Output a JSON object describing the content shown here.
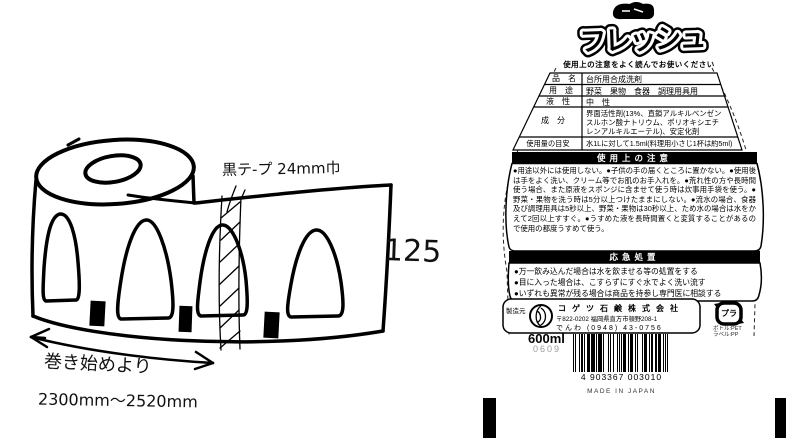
{
  "sketch": {
    "tape_note": "黒テ-プ 24mm巾",
    "count_label": "125",
    "wind_note_line1": "巻き始めより",
    "wind_note_line2": "2300mm〜2520mm"
  },
  "label": {
    "brand": "フレッシュ",
    "caution_header": "使用上の注意をよく読んでお使いください",
    "spec_table": {
      "rows": [
        {
          "label": "品　名",
          "value": "台所用合成洗剤"
        },
        {
          "label": "用　途",
          "value": "野菜　果物　食器　調理用具用"
        },
        {
          "label": "液　性",
          "value": "中　性"
        },
        {
          "label": "成　分",
          "value": "界面活性剤(13%、直鎖アルキルベンゼンスルホン酸ナトリウム、ポリオキシエチレンアルキルエーテル)、安定化剤"
        },
        {
          "label": "使用量の目安",
          "value": "水1Lに対して1.5ml(料理用小さじ1杯は約5ml)"
        }
      ]
    },
    "precautions": {
      "title": "使用上の注意",
      "body": "●用途以外には使用しない。●子供の手の届くところに置かない。●使用後は手をよく洗い、クリーム等でお肌のお手入れを。●荒れ性の方や長時間使う場合、また原液をスポンジに含ませて使う時は炊事用手袋を使う。●野菜・果物を洗う時は5分以上つけたままにしない。●流水の場合、食器及び調理用具は5秒以上、野菜・果物は30秒以上、ため水の場合は水をかえて2回以上すすぐ。●うすめた液を長時間置くと変質することがあるので使用の都度うすめて使う。"
    },
    "first_aid": {
      "title": "応急処置",
      "items": [
        "●万一飲み込んだ場合は水を飲ませる等の処置をする",
        "●目に入った場合は、こすらずにすぐ水でよく洗い流す",
        "●いずれも異常が残る場合は商品を持参し専門医に相談する"
      ]
    },
    "manufacturer": {
      "role": "製造元",
      "name": "コゲツ石鹸株式会社",
      "address": "〒822-0202 福岡県直方市頓野208-1",
      "phone": "でんわ (0948) 43-0756"
    },
    "recycle_mark": {
      "symbol": "プラ",
      "materials": [
        "ボトル:PET",
        "ラベル:PP"
      ]
    },
    "volume": "600ml",
    "lot_code": "0609",
    "barcode": {
      "digits": "4 903367 003010",
      "origin": "MADE IN JAPAN"
    }
  }
}
